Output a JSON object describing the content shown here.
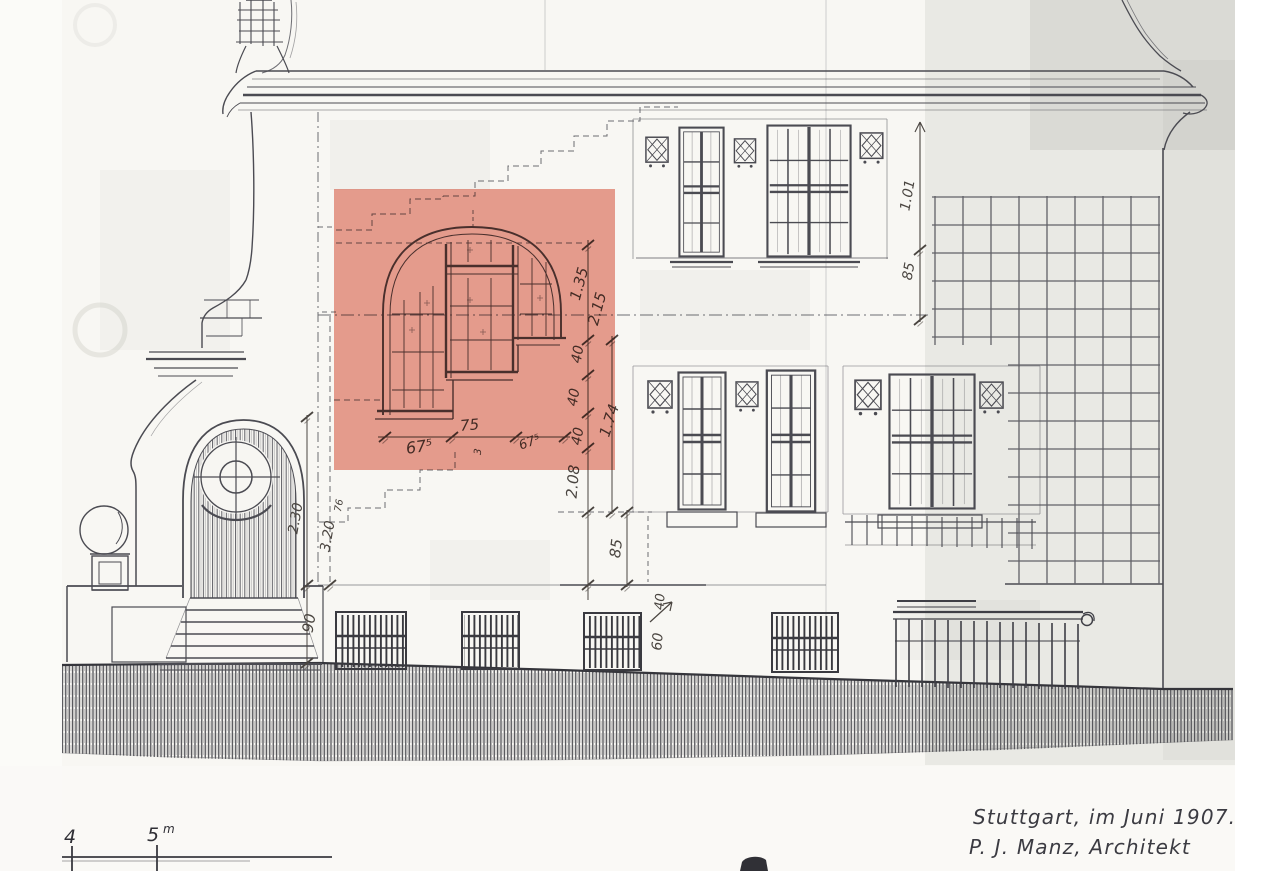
{
  "colors": {
    "highlight": "#d74127",
    "paper": "#f8f7f3",
    "ink": "#4b4b52"
  },
  "signature": {
    "location_date": "Stuttgart, im Juni 1907.",
    "architect": "P. J. Manz, Architekt"
  },
  "scale_bar": {
    "tick_4": "4",
    "tick_5": "5",
    "unit": "m"
  },
  "dimensions": {
    "arch_height": "1.35",
    "arch_total_height": "2.15",
    "step_a": "40",
    "step_b": "40",
    "step_c": "40",
    "right_height": "1.74",
    "lower_height": "2.08",
    "width_left": "67⁵",
    "width_center": "75",
    "width_center_sub": "3",
    "width_right": "67⁵",
    "upper_right_a": "1.01",
    "upper_right_b": "85",
    "mid_height": "85",
    "base_a": "40",
    "base_b": "60",
    "porch_base": "90",
    "porch_height": "2.30",
    "porch_total": "3.20",
    "porch_sub": "76"
  }
}
